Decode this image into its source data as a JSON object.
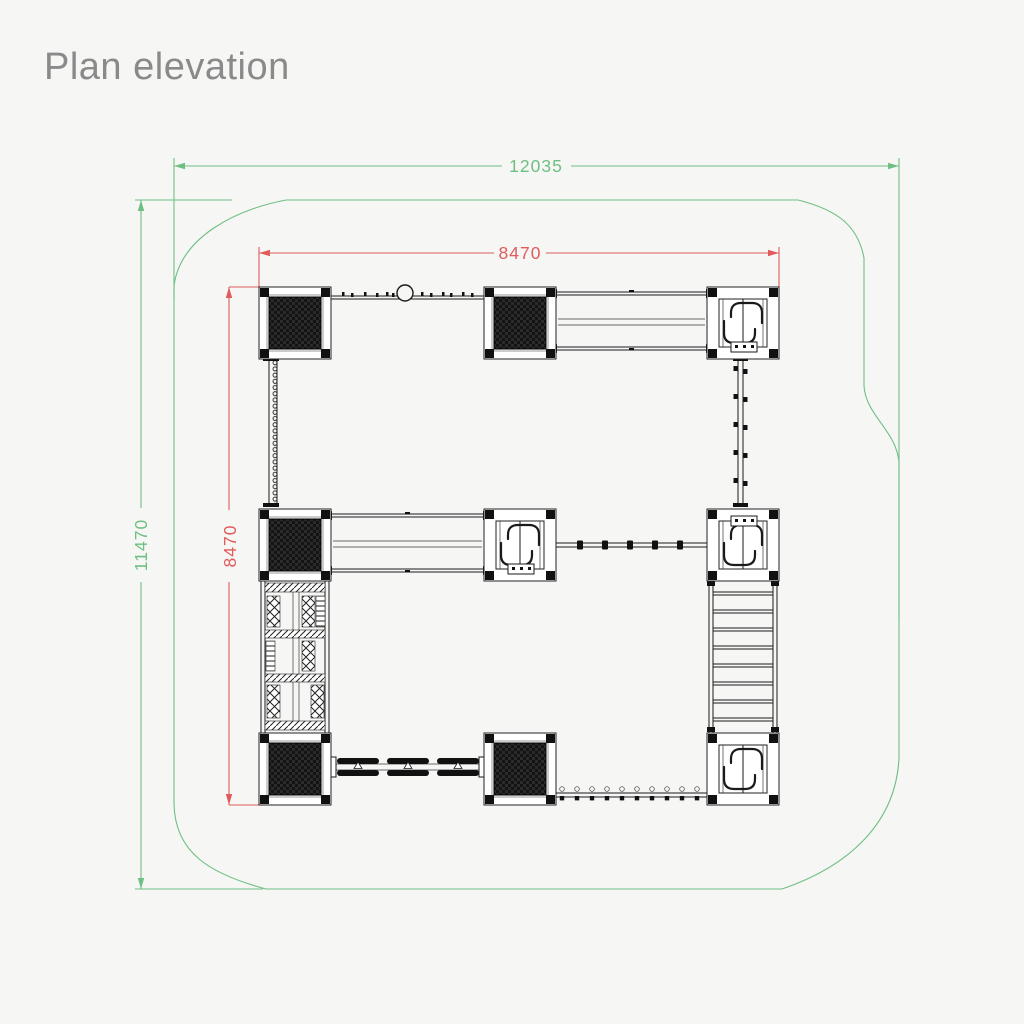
{
  "title": "Plan elevation",
  "colors": {
    "background": "#f6f6f5",
    "title_text": "#8a8a8a",
    "boundary_and_overall_dims": "#6fbf82",
    "structure_dims": "#e05b5b",
    "drawing_linework": "#1a1a1a"
  },
  "dimensions": {
    "overall_width": {
      "value": "12035",
      "orientation": "horizontal",
      "color": "#6fbf82"
    },
    "overall_height": {
      "value": "11470",
      "orientation": "vertical",
      "color": "#6fbf82"
    },
    "structure_width": {
      "value": "8470",
      "orientation": "horizontal",
      "color": "#e05b5b"
    },
    "structure_height": {
      "value": "8470",
      "orientation": "vertical",
      "color": "#e05b5b"
    }
  },
  "drawing": {
    "kind": "playground-structure-plan-view",
    "boundary": "rounded organic safety-surface outline",
    "towers": [
      {
        "id": "top-left",
        "type": "roofed"
      },
      {
        "id": "top-middle",
        "type": "roofed"
      },
      {
        "id": "top-right",
        "type": "open-deck"
      },
      {
        "id": "middle-left",
        "type": "roofed"
      },
      {
        "id": "middle-center",
        "type": "open-deck"
      },
      {
        "id": "middle-right",
        "type": "open-deck"
      },
      {
        "id": "bottom-left",
        "type": "roofed"
      },
      {
        "id": "bottom-middle",
        "type": "roofed"
      },
      {
        "id": "bottom-right",
        "type": "open-deck"
      }
    ],
    "connections": [
      {
        "from": "top-left",
        "to": "top-middle",
        "kind": "overhead-bar-with-ring"
      },
      {
        "from": "top-middle",
        "to": "top-right",
        "kind": "walkway-bridge"
      },
      {
        "from": "top-left",
        "to": "middle-left",
        "kind": "chain-climber"
      },
      {
        "from": "top-right",
        "to": "middle-right",
        "kind": "rope-climber"
      },
      {
        "from": "middle-left",
        "to": "middle-center",
        "kind": "walkway-bridge"
      },
      {
        "from": "middle-center",
        "to": "middle-right",
        "kind": "monkey-bars"
      },
      {
        "from": "middle-left",
        "to": "bottom-left",
        "kind": "climbing-maze"
      },
      {
        "from": "middle-right",
        "to": "bottom-right",
        "kind": "rung-bridge"
      },
      {
        "from": "bottom-left",
        "to": "bottom-middle",
        "kind": "stepping-pods"
      },
      {
        "from": "bottom-middle",
        "to": "bottom-right",
        "kind": "balance-rail"
      }
    ]
  }
}
